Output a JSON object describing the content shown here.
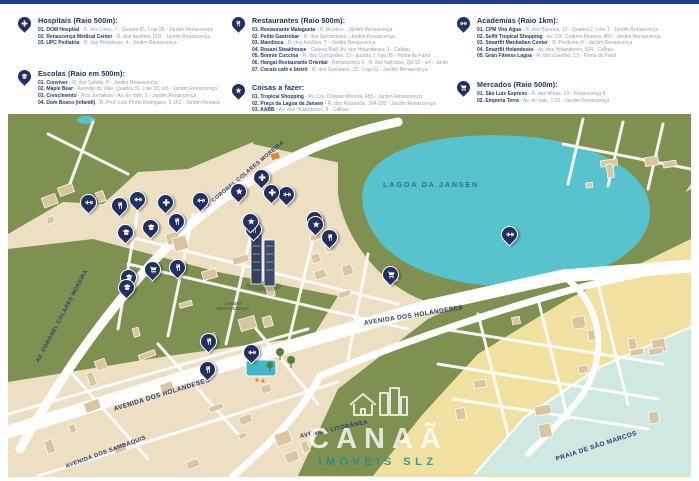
{
  "colors": {
    "top_bar": "#20408f",
    "pin_navy": "#22305f",
    "map_land": "#ecdfc2",
    "park_green": "#7e9150",
    "lagoon_teal": "#58c3cd",
    "sea": "#cfe9e2",
    "sand": "#f1e1a1",
    "accent_orange": "#e0893b"
  },
  "legend": {
    "columns": [
      {
        "sections": [
          {
            "key": "hospitais",
            "title": "Hospitais (Raio 500m):",
            "symbol": "cross",
            "items": [
              {
                "name": "01. DOM Hospital",
                "address": "R. dos Lírios, 7 - Quadra 81, Loja 05 - Jardim Renascença"
              },
              {
                "name": "02. Renascença Medical Center",
                "address": "R. dos Azulões, 503 - Jardim Renascença"
              },
              {
                "name": "03. UPC Pediatria",
                "address": "R. das Perpétuas, 4 - Jardim Renascença"
              }
            ]
          },
          {
            "key": "escolas",
            "title": "Escolas (Raio em 500m):",
            "symbol": "cap",
            "items": [
              {
                "name": "01. Conviver",
                "address": "R. dos Sabiás, 6 - Jardim Renascença"
              },
              {
                "name": "02. Maple Bear",
                "address": "Avenida do Vale, Quadra 31, Lote 20, s/n - Jardim Renascença"
              },
              {
                "name": "03. Crescimento",
                "address": "Rua Jornalista - Av. do Vale, 2 - Jardim Renascença"
              },
              {
                "name": "04. Dom Bosco (infantil)",
                "address": "R. Prof. Luís Pinho Rodrigues, 5-161 - Jardim Renascença"
              }
            ]
          }
        ]
      },
      {
        "sections": [
          {
            "key": "restaurantes",
            "title": "Restaurantes (Raio 500m):",
            "symbol": "fork",
            "items": [
              {
                "name": "01. Restaurante Malagueta",
                "address": "R. Bicudos - Jardim Renascença"
              },
              {
                "name": "02. Petite Gastrobar",
                "address": "R. dos Sarnambias - Jardim Renascença"
              },
              {
                "name": "03. Mandioca",
                "address": "R. dos Azulões, 7 - Jardim Renascença"
              },
              {
                "name": "04. Rosani Steakhouse",
                "address": "Galeria Mall, Av. dos Holandeses, 1 - Calhau"
              },
              {
                "name": "05. Bonnie Cuccina",
                "address": "R. dos Corrupiões, 13 - quadra 1, loja 06 - Ponta do Farol"
              },
              {
                "name": "06. Hangai Restaurante Oriental",
                "address": "Renascença II - R. dos Narcisos, Qd 12 - s/n - Jardim Renascença"
              },
              {
                "name": "07. Cocais café e bistrô",
                "address": "R. dos Guriatans, 23 - Loja 01 - Jardim Renascença"
              }
            ]
          },
          {
            "key": "coisas",
            "title": "Coisas a fazer:",
            "symbol": "star",
            "items": [
              {
                "name": "01. Tropical Shopping",
                "address": "Av. Col. Colares Moreira, 455 - Jardim Renascença"
              },
              {
                "name": "02. Praça da Lagoa da Jansen",
                "address": "R. dos Rouxinóis, 204-292 - Jardim Renascença"
              },
              {
                "name": "03. AABB",
                "address": "Av. dos Holandeses, 8 - Calhau"
              }
            ]
          }
        ]
      },
      {
        "sections": [
          {
            "key": "academias",
            "title": "Academias (Raio 1km):",
            "symbol": "dumbbell",
            "items": [
              {
                "name": "01. CPM Vira Água",
                "address": "R. dos Bicudos, 12 - Quadra 2, Lote 1 - Jardim Renascença"
              },
              {
                "name": "02. Selfit Tropical Shopping",
                "address": "Av. Col. Colares Moreira, 455 - Jardim Renascença"
              },
              {
                "name": "03. Smartfit Manhattan Center",
                "address": "R. Perdizes, 0 - Jardim Renascença"
              },
              {
                "name": "04. Smartfit Holandeses",
                "address": "Av. dos Holandeses, 504 - Calhau"
              },
              {
                "name": "05. Gran Fitness Lagoa",
                "address": "R. dos Gaviões, 13 - Ponta do Farol"
              }
            ]
          },
          {
            "key": "mercados",
            "title": "Mercados (Raio 500m):",
            "symbol": "cart",
            "items": [
              {
                "name": "01. São Luís Express",
                "address": "R. das Minas, 19 - Renascença II"
              },
              {
                "name": "02. Emporia Terra",
                "address": "Av. do Vale, 1-91 - Jardim Renascença"
              }
            ]
          }
        ]
      }
    ]
  },
  "map": {
    "labels": {
      "lagoa": "LAGOA DA JANSEN",
      "av_colares_left": "AV. CORONEL COLARES MOREIRA",
      "av_colares_center": "AV. CORONEL COLARES MOREIRA",
      "av_holandeses_left": "AVENIDA DOS HOLANDESES",
      "av_holandeses_right": "AVENIDA DOS HOLANDESES",
      "av_sambaquis": "AVENIDA DOS SAMBAQUIS",
      "av_litoranea": "AVENIDA LITORÂNEA",
      "praia": "PRAIA DE SÃO MARCOS",
      "jardim": "JARDIM RENASCENÇA"
    },
    "watermark": {
      "brand": "CANAÃ",
      "subtitle": "IMÓVEIS SLZ"
    },
    "pins": [
      {
        "cat": "academia",
        "sym": "dumbbell",
        "x": 80,
        "y": 98
      },
      {
        "cat": "academia",
        "sym": "dumbbell",
        "x": 129,
        "y": 95
      },
      {
        "cat": "academia",
        "sym": "dumbbell",
        "x": 192,
        "y": 96
      },
      {
        "cat": "academia",
        "sym": "dumbbell",
        "x": 278,
        "y": 90
      },
      {
        "cat": "academia",
        "sym": "dumbbell",
        "x": 501,
        "y": 130
      },
      {
        "cat": "academia",
        "sym": "dumbbell",
        "x": 243,
        "y": 248
      },
      {
        "cat": "hospital",
        "sym": "cross",
        "x": 157,
        "y": 98
      },
      {
        "cat": "hospital",
        "sym": "cross",
        "x": 253,
        "y": 73
      },
      {
        "cat": "hospital",
        "sym": "cross",
        "x": 263,
        "y": 88
      },
      {
        "cat": "restaurante",
        "sym": "fork",
        "x": 111,
        "y": 101
      },
      {
        "cat": "restaurante",
        "sym": "fork",
        "x": 168,
        "y": 117
      },
      {
        "cat": "restaurante",
        "sym": "fork",
        "x": 245,
        "y": 125
      },
      {
        "cat": "restaurante",
        "sym": "fork",
        "x": 169,
        "y": 163
      },
      {
        "cat": "restaurante",
        "sym": "fork",
        "x": 200,
        "y": 237
      },
      {
        "cat": "restaurante",
        "sym": "fork",
        "x": 199,
        "y": 265
      },
      {
        "cat": "restaurante",
        "sym": "fork",
        "x": 321,
        "y": 133
      },
      {
        "cat": "escola",
        "sym": "cap",
        "x": 117,
        "y": 128
      },
      {
        "cat": "escola",
        "sym": "cap",
        "x": 142,
        "y": 123
      },
      {
        "cat": "escola",
        "sym": "cap",
        "x": 120,
        "y": 173
      },
      {
        "cat": "escola",
        "sym": "cap",
        "x": 118,
        "y": 183
      },
      {
        "cat": "mercado",
        "sym": "cart",
        "x": 306,
        "y": 115
      },
      {
        "cat": "mercado",
        "sym": "cart",
        "x": 382,
        "y": 170
      },
      {
        "cat": "mercado",
        "sym": "cart",
        "x": 144,
        "y": 165
      },
      {
        "cat": "coisa",
        "sym": "star",
        "x": 230,
        "y": 87
      },
      {
        "cat": "coisa",
        "sym": "star",
        "x": 307,
        "y": 120
      },
      {
        "cat": "coisa",
        "sym": "star",
        "x": 242,
        "y": 117
      }
    ]
  }
}
